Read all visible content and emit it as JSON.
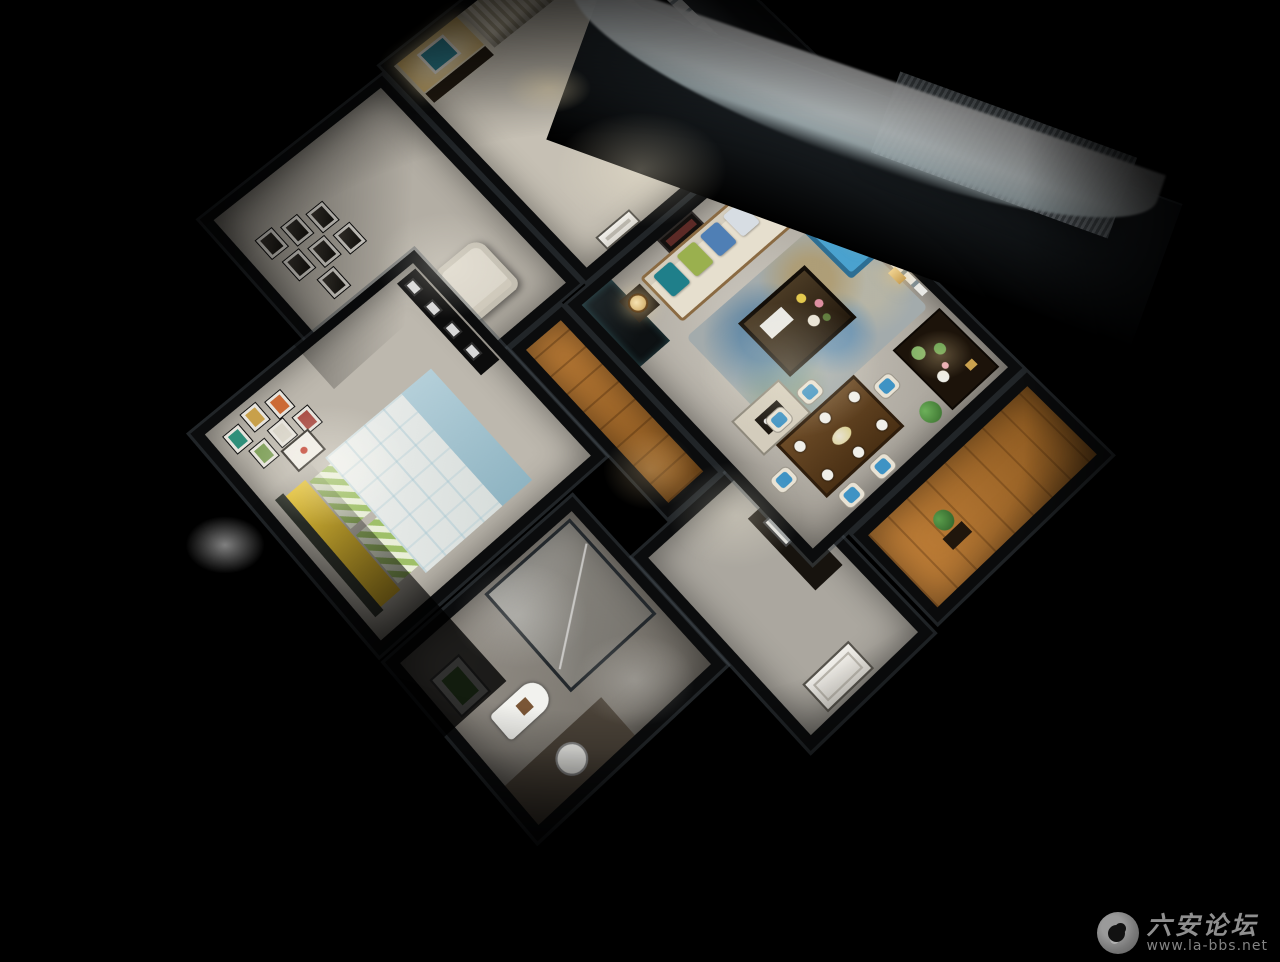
{
  "image": {
    "type": "3d-dollhouse-apartment-render",
    "description": "Aerial night cutaway render of a furnished two-bedroom apartment on a black background",
    "background": "#000000"
  },
  "watermark": {
    "site_name": "六安论坛",
    "site_url": "www.la-bbs.net",
    "text_color": "#a8a8a8"
  },
  "palette": {
    "floor_tile": "#c7c2b8",
    "wood_floor": "#b5772f",
    "wall_cut": "#0d0f10",
    "accent_blue": "#4aa2cf",
    "accent_teal": "#2e8292",
    "accent_yellow": "#eecb3a",
    "celadon_green": "#7fb266",
    "curtain_beige": "#d6cdba",
    "lamp_warm": "#f5dfa8",
    "roof_sheen": "#9fb6bd"
  },
  "rooms": [
    {
      "id": "master-bedroom",
      "features": [
        "full curtain wall",
        "lit niche with teal abstract art",
        "low dresser"
      ]
    },
    {
      "id": "study",
      "features": [
        "gallery wall of framed prints",
        "cream tufted armchair",
        "dark console"
      ]
    },
    {
      "id": "second-bedroom",
      "features": [
        "bed with yellow bolster and checked duvet",
        "colorful mini picture frames",
        "white nightstand",
        "black frame ledge"
      ]
    },
    {
      "id": "bathroom",
      "features": [
        "glass shower enclosure",
        "toilet",
        "round basin",
        "framed botanical print",
        "dark vanity"
      ]
    },
    {
      "id": "corridor",
      "features": [
        "orange wood flooring"
      ]
    },
    {
      "id": "entry-hall",
      "features": [
        "white panel door",
        "dark cabinet with mirror frame"
      ]
    },
    {
      "id": "living-room",
      "features": [
        "cream sofa with teal green blue cushions",
        "twin table lamps",
        "blue chaise lounge",
        "mottled blue-tan rug",
        "dark wood coffee table with flowers",
        "tray table",
        "white french doors",
        "tv console with celadon vases",
        "gold wall sconces"
      ]
    },
    {
      "id": "dining-area",
      "features": [
        "wood table with six place settings",
        "blue and white chairs",
        "flower centerpiece",
        "topiary plant"
      ]
    },
    {
      "id": "balcony",
      "features": [
        "gray roller shade",
        "white window mullions",
        "wood deck"
      ]
    }
  ]
}
